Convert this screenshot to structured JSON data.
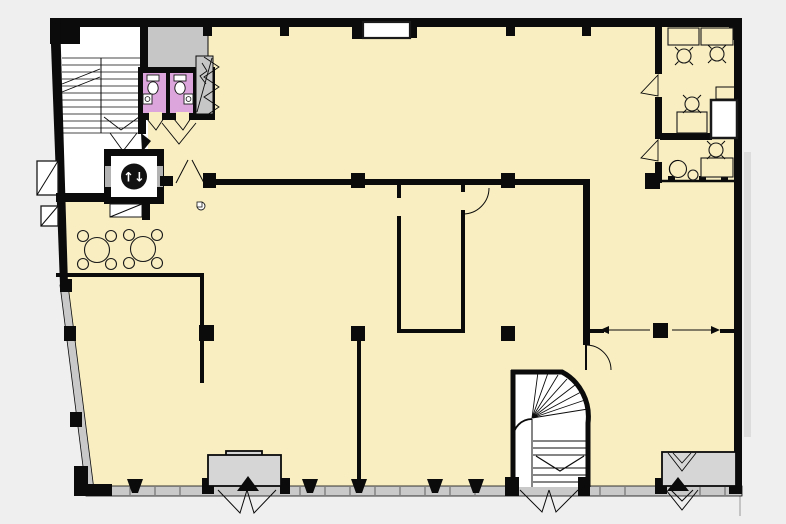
{
  "title": "Office building floor plan",
  "canvas": {
    "width": 786,
    "height": 524
  },
  "colors": {
    "background": "#efefef",
    "floor": "#f8eec1",
    "wall": "#0b0b0b",
    "white": "#ffffff",
    "room_gray": "#c6c6c6",
    "band_gray": "#c9c9c9",
    "vestibule_gray": "#d6d6d6",
    "hatch_gray": "#dcdcdc",
    "wc_pink": "#dca6dc",
    "elevator_badge": "#111111",
    "elevator_arrow_color": "#ffffff"
  },
  "icons": {
    "elevator_arrows": "↑↓",
    "entrance_marker": "▲"
  },
  "inventory": {
    "wc_stalls": 2,
    "cafe_tables": 2,
    "cafe_chairs": 8,
    "office_desks": 4,
    "office_chairs": 4,
    "armchairs": 1,
    "elevators": 1,
    "straight_staircases": 1,
    "curved_staircases": 1,
    "entrance_vestibules": 2
  }
}
